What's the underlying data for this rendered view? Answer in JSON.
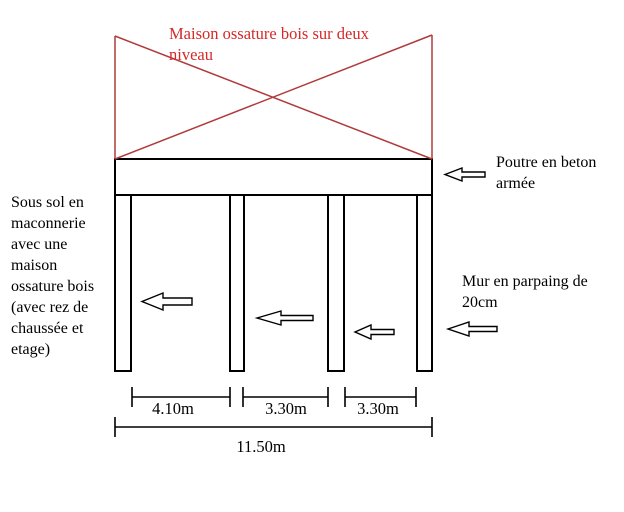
{
  "title": {
    "text": "Maison ossature bois sur deux\nniveau"
  },
  "notes": {
    "left": "Sous sol en\nmaconnerie\navec une\nmaison\nossature bois\n(avec rez de\nchaussée et\netage)",
    "beam": "Poutre en beton\narmée",
    "wall": "Mur en parpaing de\n20cm"
  },
  "dimensions": {
    "bay1": "4.10m",
    "bay2": "3.30m",
    "bay3": "3.30m",
    "total": "11.50m"
  },
  "colors": {
    "red_line": "#b03a3a",
    "red_text": "#d52929",
    "ink": "#000000"
  }
}
